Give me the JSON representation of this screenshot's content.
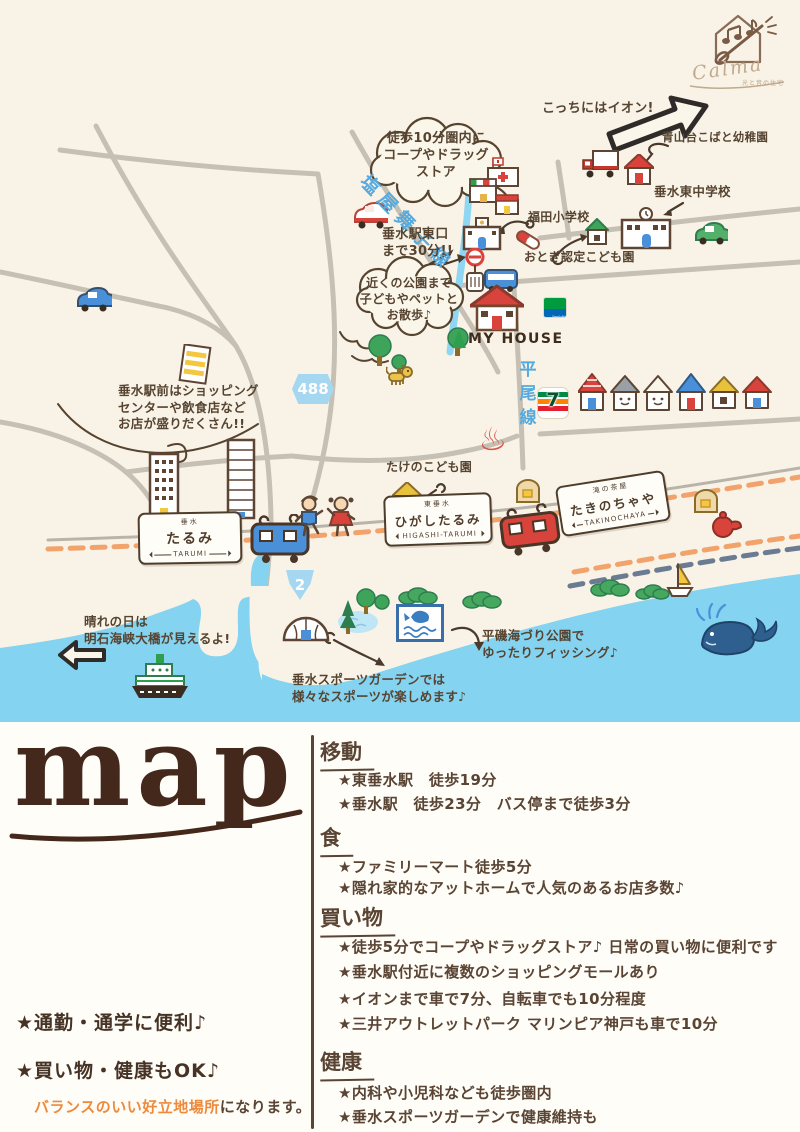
{
  "logo": {
    "brand": "Calma",
    "tagline": "光と音の住宅"
  },
  "map": {
    "notes": {
      "aeon": "こっちにはイオン!",
      "kobato_kindergarten": "青山台こばと幼稚園",
      "tarumi_higashi_jhs": "垂水東中学校",
      "walk10_cloud": "徒歩10分圏内に\nコープやドラッグ\nストア",
      "shioya_maiko_line": "塩屋舞子線",
      "station_east_exit": "垂水駅東口\nまで30分!!",
      "fukuda_es": "福田小学校",
      "otogi_kodomoen": "おとぎ認定こども園",
      "park_cloud": "近くの公園まで\n子どもやペットと\nお散歩♪",
      "my_house": "MY HOUSE",
      "ekimae": "垂水駅前はショッピング\nセンターや飲食店など\nお店が盛りだくさん!!",
      "hirao_line": "平尾線",
      "takeno_kodomoen": "たけのこども園",
      "akashi": "晴れの日は\n明石海峡大橋が見えるよ!",
      "sports_garden": "垂水スポーツガーデンでは\n様々なスポーツが楽しめます♪",
      "hiraiso": "平磯海づり公園で\nゆったりフィッシング♪"
    },
    "badges": {
      "route488": "488",
      "route2": "2",
      "seven": "7",
      "familymart": "FamilyMart"
    },
    "onsen_mark": "♨",
    "stations": {
      "tarumi": {
        "small": "垂水",
        "main": "たるみ",
        "romaji": "TARUMI"
      },
      "higashi_tarumi": {
        "small": "東垂水",
        "main": "ひがしたるみ",
        "romaji": "HIGASHI-TARUMI"
      },
      "takinochaya": {
        "small": "滝の茶屋",
        "main": "たきのちゃや",
        "romaji": "TAKINOCHAYA"
      }
    }
  },
  "bottom": {
    "title": "map",
    "highlights": [
      "★通勤・通学に便利♪",
      "★買い物・健康もOK♪"
    ],
    "tagline": {
      "em": "バランスのいい好立地場所",
      "rest": "になります。"
    },
    "sections": [
      {
        "title": "移動",
        "items": [
          "★東垂水駅　徒歩19分",
          "★垂水駅　徒歩23分　バス停まで徒歩3分"
        ]
      },
      {
        "title": "食",
        "items": [
          "★ファミリーマート徒歩5分",
          "★隠れ家的なアットホームで人気のあるお店多数♪"
        ]
      },
      {
        "title": "買い物",
        "items": [
          "★徒歩5分でコープやドラッグストア♪ 日常の買い物に便利です",
          "★垂水駅付近に複数のショッピングモールあり",
          "★イオンまで車で7分、自転車でも10分程度",
          "★三井アウトレットパーク マリンピア神戸も車で10分"
        ]
      },
      {
        "title": "健康",
        "items": [
          "★内科や小児科なども徒歩圏内",
          "★垂水スポーツガーデンで健康維持も"
        ]
      }
    ]
  },
  "colors": {
    "accent_brown": "#5a4433",
    "water": "#84d3f0",
    "orange": "#ed8a3c",
    "red": "#d8433b",
    "line_blue": "#56aadd"
  }
}
